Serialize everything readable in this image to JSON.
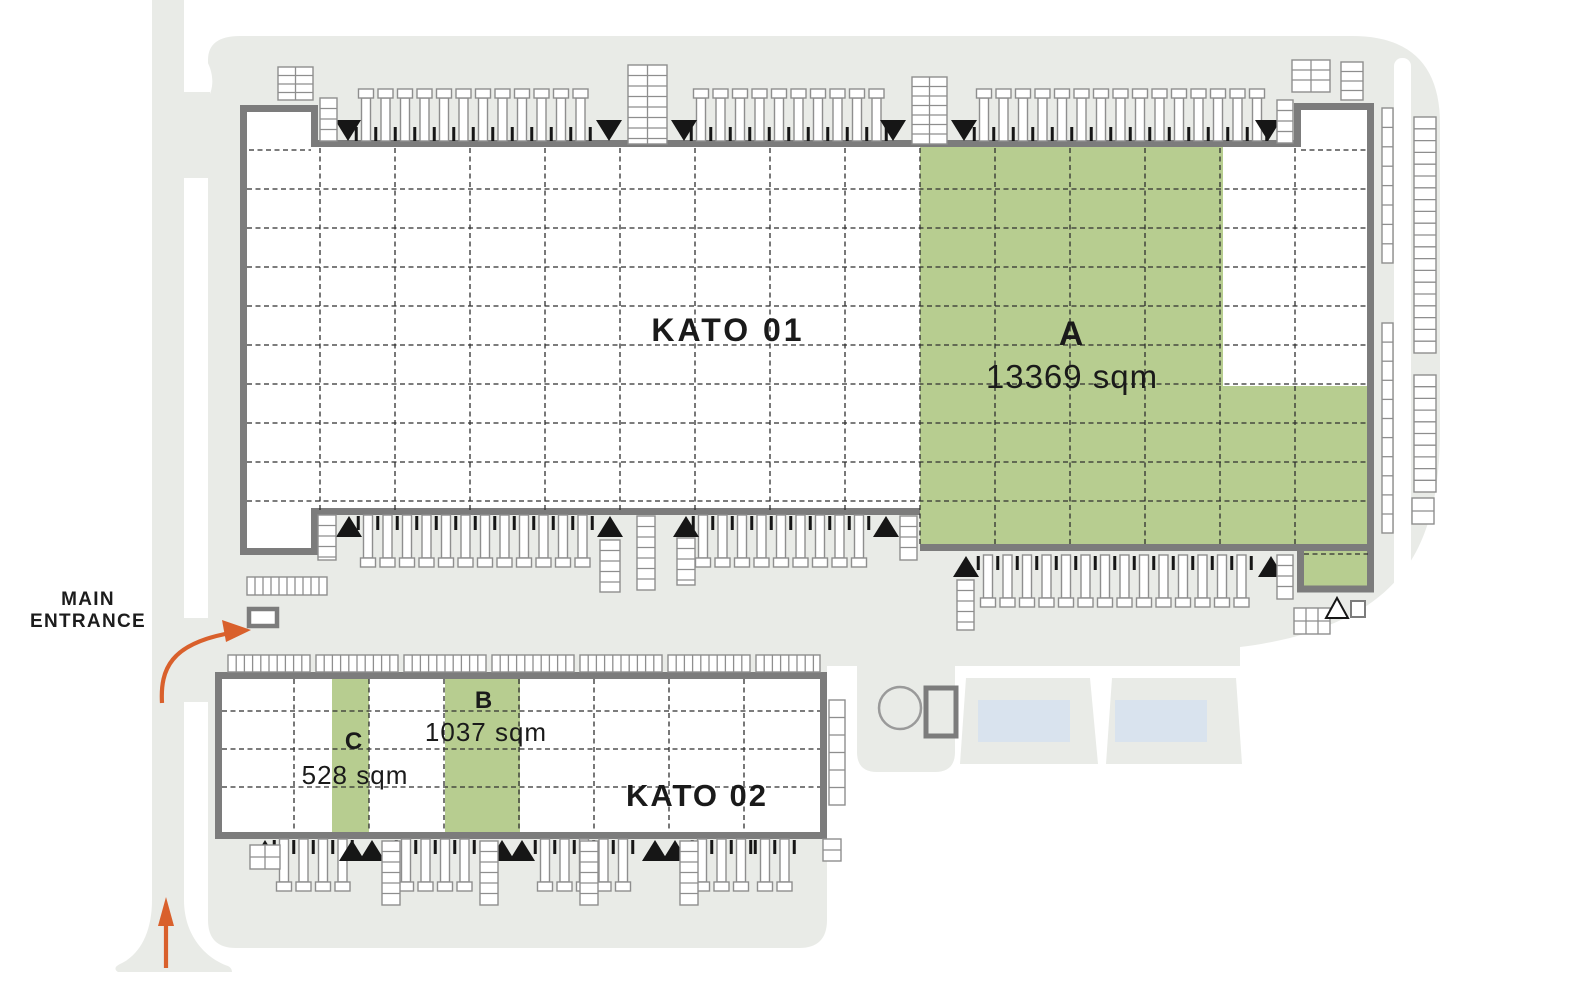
{
  "plan": {
    "title": "Warehouse site plan",
    "buildings": [
      {
        "name": "kato-01",
        "label": "KATO 01",
        "units": [
          {
            "id": "A",
            "label": "A",
            "area_label": "13369 sqm",
            "status": "available"
          }
        ]
      },
      {
        "name": "kato-02",
        "label": "KATO 02",
        "units": [
          {
            "id": "B",
            "label": "B",
            "area_label": "1037 sqm",
            "status": "available"
          },
          {
            "id": "C",
            "label": "C",
            "area_label": "528 sqm",
            "status": "available"
          }
        ]
      }
    ],
    "entrance": {
      "line1": "MAIN",
      "line2": "ENTRANCE"
    }
  },
  "colors": {
    "available_green": "#b7cd90",
    "road_gray": "#e9ebe7",
    "wall_gray": "#7c7c7c",
    "accent_orange": "#d9602c",
    "water_blue": "#d9e3ee",
    "ink": "#1a1a1a"
  }
}
